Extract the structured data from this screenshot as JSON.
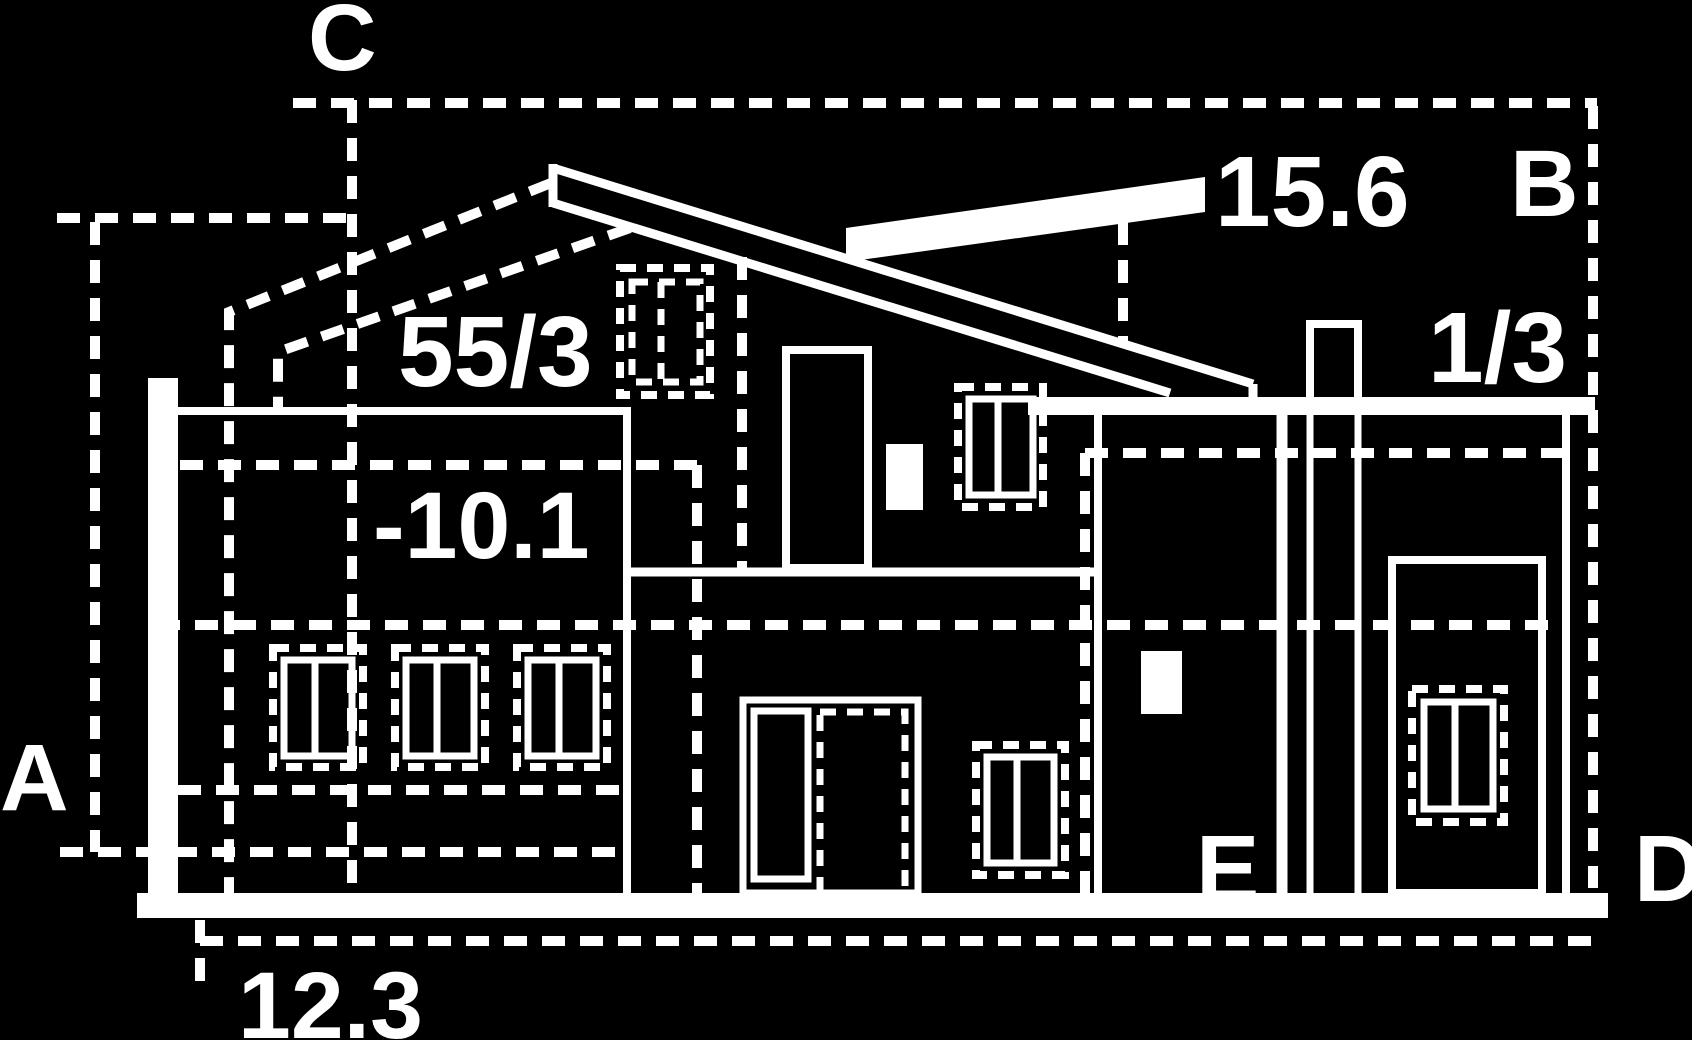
{
  "drawing": {
    "background_color": "#000000",
    "line_color": "#ffffff"
  },
  "reference_labels": {
    "a": "A",
    "b": "B",
    "c": "C",
    "d": "D",
    "e": "E"
  },
  "measurements": {
    "roof_panel": "15.6",
    "ratio": "1/3",
    "gable": "55/3",
    "level": "-10.1",
    "base_width": "12.3"
  }
}
